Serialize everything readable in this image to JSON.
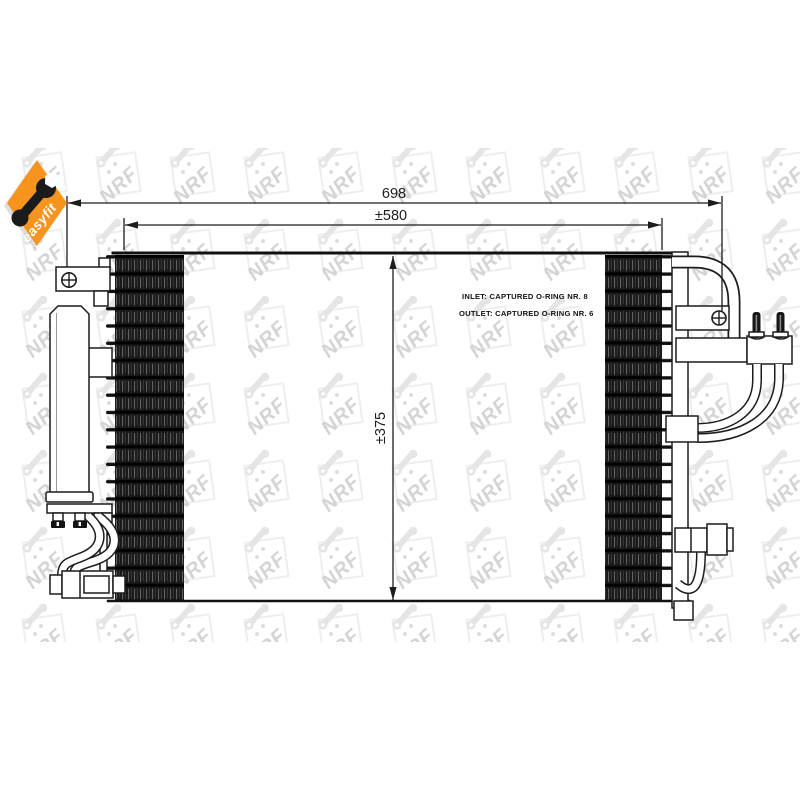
{
  "image": {
    "width": 800,
    "height": 800,
    "background": "#ffffff"
  },
  "badge": {
    "label": "easyfit",
    "background_color": "#F7941E",
    "text_color": "#ffffff",
    "icon": "wrench-icon"
  },
  "watermark": {
    "brand": "NRF",
    "tile_text": "NRF"
  },
  "drawing": {
    "type": "technical-line-drawing",
    "subject": "NRF air-conditioning condenser with receiver drier",
    "line_color": "#1c1c1c",
    "dimensions": {
      "overall_width_label": "698",
      "core_width_label": "±580",
      "core_height_label": "±375"
    },
    "annotations": {
      "inlet_label": "INLET: CAPTURED O-RING NR. 8",
      "outlet_label": "OUTLET: CAPTURED O-RING NR. 6"
    },
    "icons": {
      "screw": "screw-cross-icon",
      "badge": "wrench-icon"
    }
  }
}
